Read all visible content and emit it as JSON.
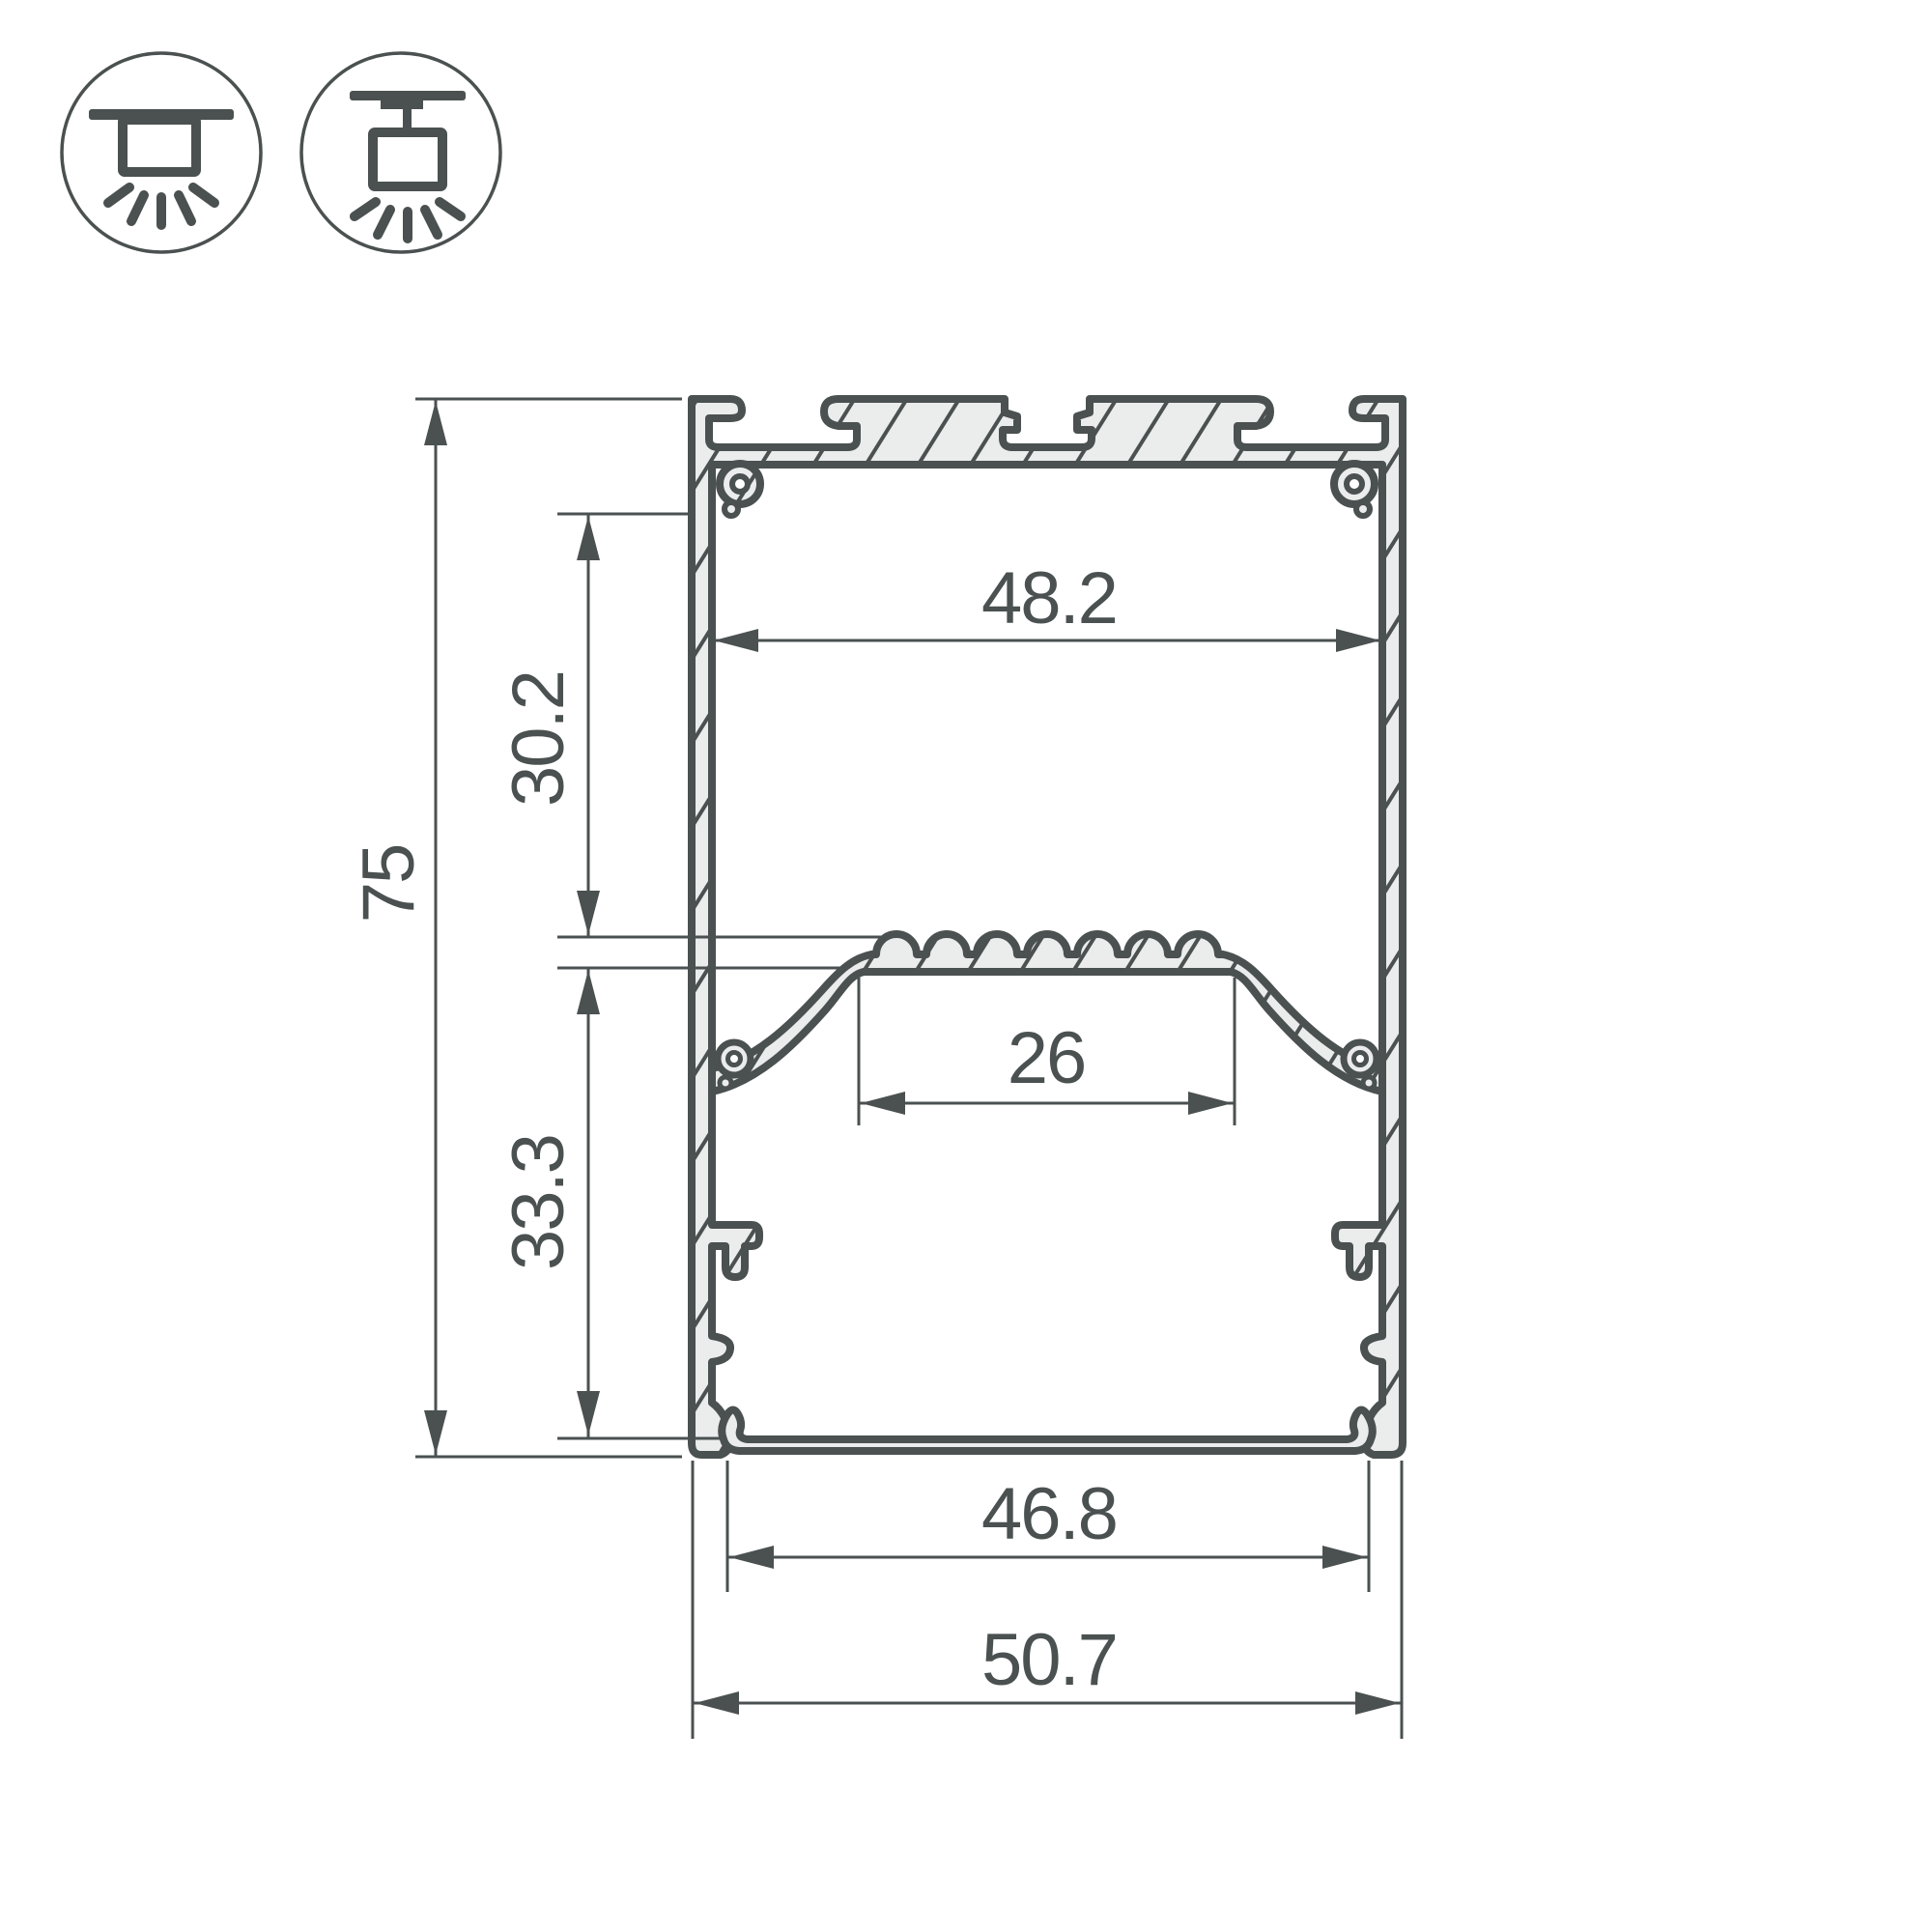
{
  "colors": {
    "line": "#4a5150",
    "metal": "#ebecec",
    "background": "#ffffff"
  },
  "icons": {
    "surface_mount": "surface-mount-icon",
    "pendant_mount": "pendant-mount-icon"
  },
  "dimensions": {
    "overall_height": "75",
    "upper_inner_height": "30.2",
    "lower_inner_height": "33.3",
    "top_inner_width": "48.2",
    "led_platform_width": "26",
    "bottom_inner_width": "46.8",
    "overall_width": "50.7"
  }
}
